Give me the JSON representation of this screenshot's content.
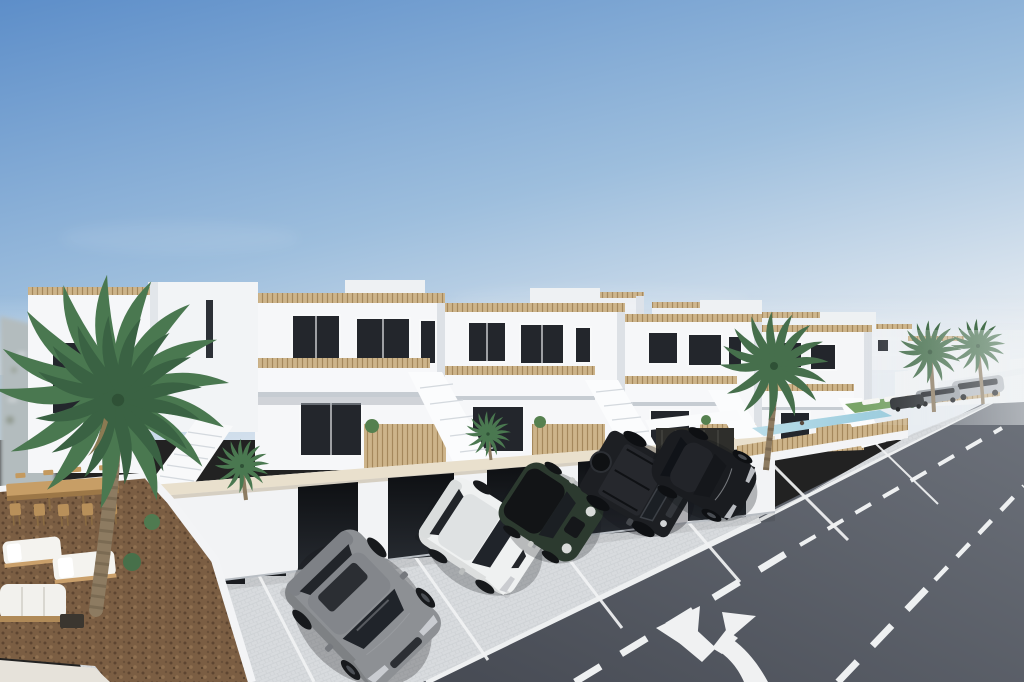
{
  "scene": {
    "type": "architectural-render",
    "setting": "new-build seaside townhouse development with street, parking, communal pool and palm trees",
    "time_of_day": "day",
    "weather": "clear"
  },
  "palette": {
    "sky_top": "#5d8ec9",
    "sky_mid": "#9dbedd",
    "sky_horizon": "#e8edf2",
    "building_white": "#f6f7f9",
    "building_shade": "#dde1e6",
    "window_dark": "#23262c",
    "window_frame": "#f8f9fa",
    "railing_cane": "#cdb48a",
    "cane_stroke": "#a5885c",
    "wall_cap_cream": "#e9e0cd",
    "garage_door_dark": "#15171b",
    "pavement": "#d8dbde",
    "stall_line": "#f2f3f4",
    "road_near": "#464a53",
    "road_far": "#6e737c",
    "road_marking": "#f0f1f2",
    "mulch": "#7b5e43",
    "palm_green": "#4a7850",
    "palm_green_distant": "#466f4c",
    "palm_trunk": "#8d7b61",
    "pool_water": "#a9d3e2",
    "grass": "#79a468",
    "haze": "#eef2f4",
    "terrain_haze": "#b3bcbe",
    "furniture_wood": "#c79e66",
    "cushion_white": "#f4f3ef"
  },
  "objects": {
    "buildings": {
      "style": "modern white Mediterranean townhouses",
      "rows": 2,
      "features": [
        "roof terraces with cane railings",
        "balconies",
        "external staircases",
        "garages",
        "cane privacy fences"
      ]
    },
    "cars": [
      {
        "id": "car-grey-sedan",
        "body": "sedan",
        "hex": "#8d9094"
      },
      {
        "id": "car-white-sedan",
        "body": "sedan",
        "hex": "#eff1f1"
      },
      {
        "id": "car-green-mini",
        "body": "hatchback",
        "hex": "#2c3a2f"
      },
      {
        "id": "car-black-suv",
        "body": "boxy SUV",
        "hex": "#1d1f23"
      },
      {
        "id": "car-black-coupe",
        "body": "coupe",
        "hex": "#1a1c20"
      },
      {
        "id": "car-distant-silver",
        "body": "suv",
        "hex": "#b6bac0"
      },
      {
        "id": "car-distant-grey",
        "body": "sedan",
        "hex": "#9aa0a6"
      },
      {
        "id": "car-distant-dark",
        "body": "sedan",
        "hex": "#2a2d31"
      }
    ],
    "palm_trees": {
      "count": 6
    },
    "pool": {
      "shape": "elongated rectangle",
      "water_hex": "#a9d3e2"
    },
    "road": {
      "surface": "asphalt",
      "markings": [
        "edge line",
        "dashed lane line",
        "dashed lane line",
        "fork arrow"
      ]
    },
    "terrace": {
      "ground": "bark mulch",
      "furniture": [
        "dining table",
        "bar stools",
        "sun loungers",
        "outdoor sofa",
        "coffee table"
      ]
    }
  }
}
